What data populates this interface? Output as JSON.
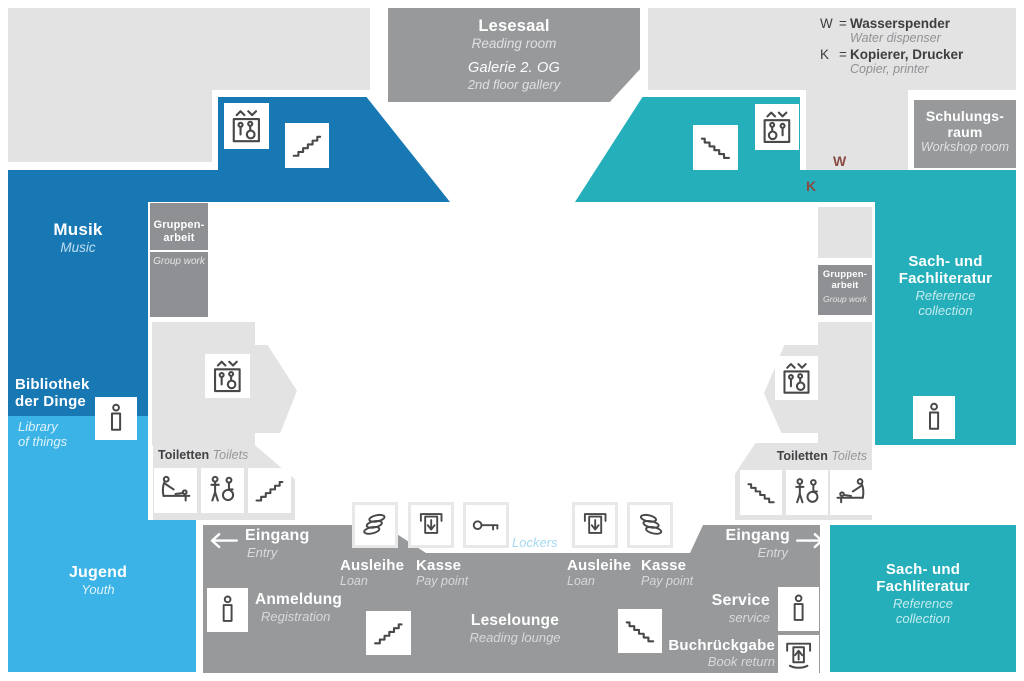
{
  "colors": {
    "dark_blue": "#1878b4",
    "light_blue": "#3bb3e6",
    "teal": "#25afba",
    "gray_bar": "#97999b",
    "gray_box": "#8e9093",
    "light_gray": "#e3e3e4",
    "icon_stroke": "#48484a",
    "wk_marker": "#8a4a42",
    "lockers_text": "#a5d9f2"
  },
  "legend": {
    "water": {
      "key": "W",
      "eq": "=",
      "de": "Wasserspender",
      "en": "Water dispenser"
    },
    "copier": {
      "key": "K",
      "eq": "=",
      "de": "Kopierer, Drucker",
      "en": "Copier, printer"
    }
  },
  "markers": {
    "water": "W",
    "copier": "K"
  },
  "rooms": {
    "lesesaal": {
      "de": "Lesesaal",
      "en": "Reading room"
    },
    "galerie": {
      "de": "Galerie 2. OG",
      "en": "2nd floor gallery"
    },
    "schulungsraum": {
      "de1": "Schulungs-",
      "de2": "raum",
      "en": "Workshop room"
    },
    "musik": {
      "de": "Musik",
      "en": "Music"
    },
    "bibliothek": {
      "de1": "Bibliothek",
      "de2": "der Dinge",
      "en1": "Library",
      "en2": "of things"
    },
    "jugend": {
      "de": "Jugend",
      "en": "Youth"
    },
    "gruppenarbeit": {
      "de1": "Gruppen-",
      "de2": "arbeit",
      "en": "Group work"
    },
    "sach": {
      "de1": "Sach- und",
      "de2": "Fachliteratur",
      "en1": "Reference",
      "en2": "collection"
    },
    "leselounge": {
      "de": "Leselounge",
      "en": "Reading lounge"
    }
  },
  "services": {
    "eingang": {
      "de": "Eingang",
      "en": "Entry"
    },
    "ausleihe": {
      "de": "Ausleihe",
      "en": "Loan"
    },
    "kasse": {
      "de": "Kasse",
      "en": "Pay point"
    },
    "anmeldung": {
      "de": "Anmeldung",
      "en": "Registration"
    },
    "service": {
      "de": "Service",
      "en": "service"
    },
    "buchrueckgabe": {
      "de": "Buchrückgabe",
      "en": "Book return"
    },
    "toiletten": {
      "de": "Toiletten",
      "en": "Toilets"
    },
    "lockers": {
      "en": "Lockers"
    }
  },
  "icons": {
    "elevator-icon": "lift box with up/down chevrons, person and wheelchair",
    "stairs-up-icon": "ascending steps",
    "stairs-down-icon": "descending steps",
    "baby-changing-icon": "adult bending over changing table with baby",
    "accessible-toilet-icon": "standing person and wheelchair user",
    "media-stack-icon": "stack of three tilted discs",
    "pay-machine-icon": "terminal with downward arrow",
    "key-icon": "horizontal key",
    "info-icon": "information pillar (i)",
    "book-return-icon": "book with upward arrow into slot",
    "arrow-left-icon": "left arrow",
    "arrow-right-icon": "right arrow"
  }
}
